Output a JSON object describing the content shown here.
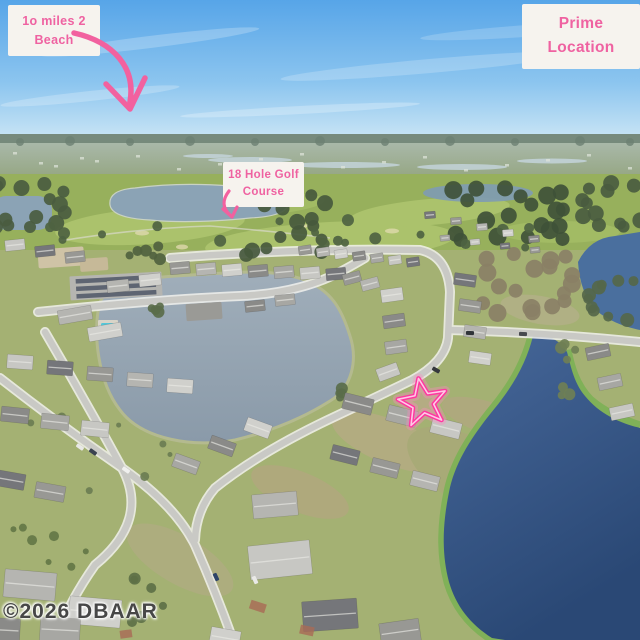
{
  "annotations": {
    "beach_badge": {
      "line1": "1o miles 2",
      "line2": "Beach"
    },
    "prime_badge": {
      "line1": "Prime",
      "line2": "Location"
    },
    "golf_badge": {
      "line1": "18 Hole Golf",
      "line2": "Course"
    },
    "colors": {
      "badge_text_pink": "#ef62a1",
      "badge_background": "#f6f3ee",
      "arrow_pink": "#f2619f",
      "star_pink": "#ff37a0"
    },
    "markers": [
      "curved-arrow-to-horizon",
      "small-arrow-to-fairway",
      "hand-drawn-star-on-home"
    ]
  },
  "watermark": {
    "text": "©2026 DBAAR"
  }
}
